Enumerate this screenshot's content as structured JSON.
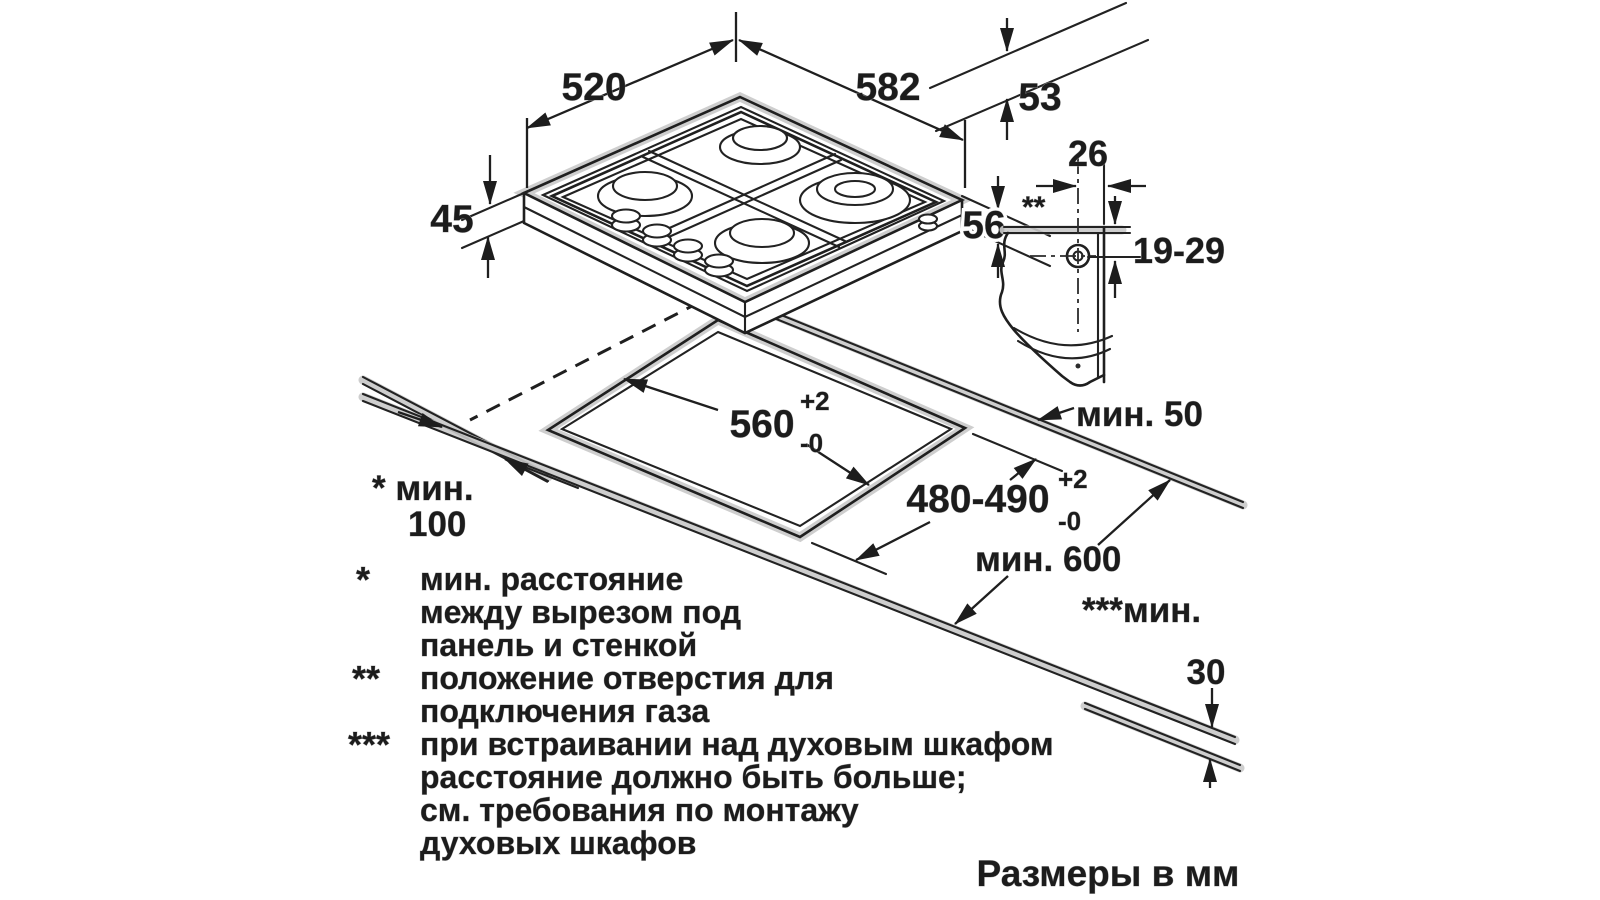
{
  "drawing": {
    "hob": {
      "width": "582",
      "depth": "520",
      "grate_height": "53",
      "height_above_worktop": "45",
      "total_height": "56"
    },
    "gas_connection": {
      "horizontal_offset": "26",
      "note_marker": "**",
      "vertical_range": "19-29"
    },
    "cutout": {
      "width": "560",
      "width_tol_plus": "+2",
      "width_tol_minus": "-0",
      "depth": "480-490",
      "depth_tol_plus": "+2",
      "depth_tol_minus": "-0",
      "rear_clearance": "мин. 50",
      "worktop_min_depth": "мин. 600",
      "side_clearance_label": "* мин.",
      "side_clearance_value": "100",
      "bottom_clearance_label": "***мин.",
      "bottom_clearance_value": "30"
    }
  },
  "legend": {
    "rows": [
      {
        "marker": "*",
        "lines": [
          "мин. расстояние",
          "между вырезом под",
          "панель и стенкой"
        ]
      },
      {
        "marker": "**",
        "lines": [
          "положение отверстия для",
          "подключения газа"
        ]
      },
      {
        "marker": "***",
        "lines": [
          "при встраивании над духовым шкафом",
          "расстояние должно быть больше;",
          "см. требования по монтажу",
          "духовых шкафов"
        ]
      }
    ]
  },
  "footer": {
    "units_note": "Размеры в мм"
  }
}
